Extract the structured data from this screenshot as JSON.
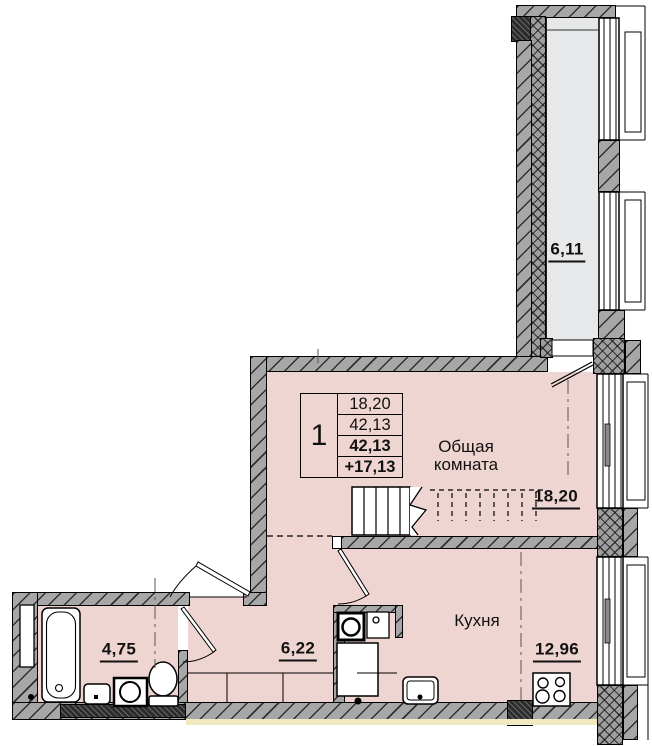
{
  "unit_table": {
    "unit_number": "1",
    "values": [
      "18,20",
      "42,13",
      "42,13",
      "+17,13"
    ]
  },
  "rooms": {
    "living": {
      "label_line1": "Общая",
      "label_line2": "комната",
      "area": "18,20"
    },
    "kitchen": {
      "label": "Кухня",
      "area": "12,96"
    },
    "hallway": {
      "area": "6,22"
    },
    "bathroom": {
      "area": "4,75"
    },
    "balcony": {
      "area": "6,11"
    }
  },
  "colors": {
    "room_fill": "#efd5d1",
    "balcony_fill": "#e6e8e9",
    "wall_fill": "#a7a7a7",
    "label_text": "#111111",
    "plinth_strip": "#f1e9c0"
  }
}
